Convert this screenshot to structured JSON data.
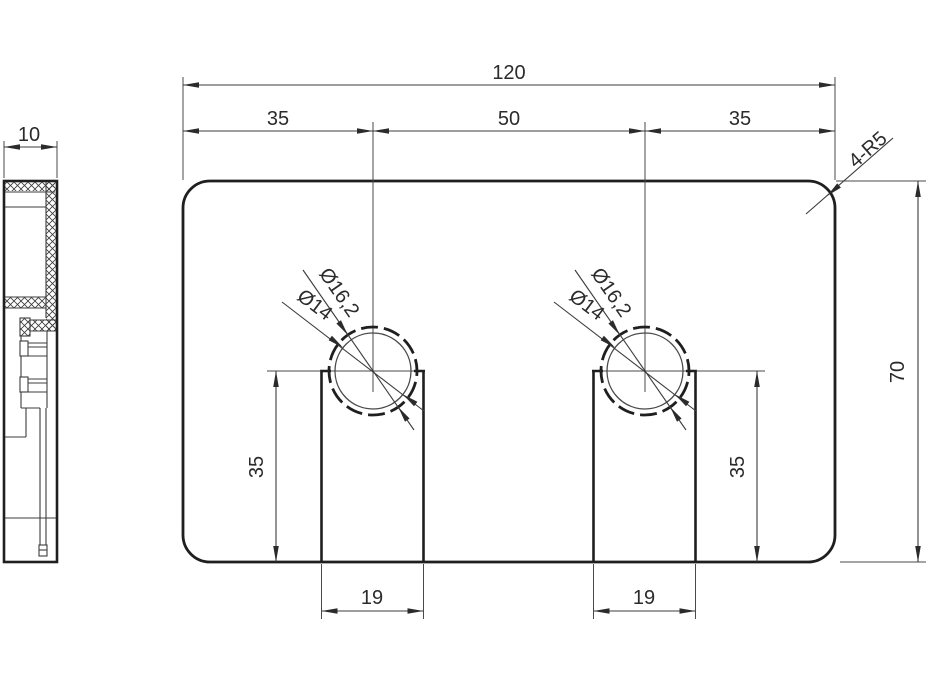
{
  "colors": {
    "line": "#1f1f1f",
    "dim_line": "#3c3c3c",
    "background": "#ffffff"
  },
  "drawing": {
    "overall_width": "120",
    "offset_left": "35",
    "center_distance": "50",
    "offset_right": "35",
    "corner_radius_callout": "4-R5",
    "overall_height": "70",
    "thickness": "10",
    "slot_depth_left": "35",
    "slot_depth_right": "35",
    "slot_width_left": "19",
    "slot_width_right": "19",
    "hole1_outer_dia": "Ø16,2",
    "hole1_inner_dia": "Ø14",
    "hole2_outer_dia": "Ø16,2",
    "hole2_inner_dia": "Ø14"
  }
}
